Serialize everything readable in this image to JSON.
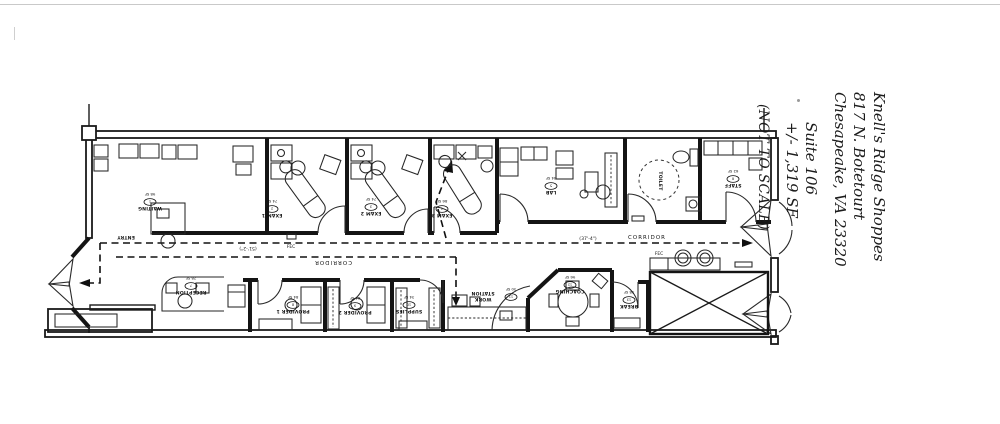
{
  "title_block": {
    "line1": "Knell's Ridge Shoppes",
    "line2": "817 N. Botetourt",
    "line3": "Chesapeake, VA 23320",
    "line4": "Suite 106",
    "line5": "+/- 1,319 SF",
    "line6": "(NOT TO SCALE)"
  },
  "labels": {
    "waiting": {
      "name": "WAITING",
      "tag": "1",
      "area": "98 SF"
    },
    "exam1": {
      "name": "EXAM 1",
      "tag": "2",
      "area": "74 SF"
    },
    "exam2": {
      "name": "EXAM 2",
      "tag": "3",
      "area": "74 SF"
    },
    "exam3": {
      "name": "EXAM 3",
      "tag": "4",
      "area": "86 SF"
    },
    "lab": {
      "name": "LAB",
      "tag": "5",
      "area": "84 SF"
    },
    "toilet": {
      "name": "TOILET"
    },
    "staff": {
      "name": "STAFF",
      "tag": "6",
      "area": "62 SF"
    },
    "entry": {
      "name": "ENTRY"
    },
    "reception": {
      "name": "RECEPTION",
      "tag": "7",
      "area": "78 SF"
    },
    "provider1": {
      "name": "PROVIDER 1",
      "tag": "8",
      "area": "84 SF"
    },
    "provider2": {
      "name": "PROVIDER 2",
      "tag": "9",
      "area": "84 SF"
    },
    "supplies": {
      "name": "SUPPLIES",
      "tag": "10",
      "area": "34 SF"
    },
    "workstation": {
      "name_line1": "WORK",
      "name_line2": "STATION",
      "tag": "11",
      "area": "30 SF"
    },
    "coaching": {
      "name": "COACHING",
      "tag": "12",
      "area": "96 SF"
    },
    "breakroom": {
      "name": "BREAK",
      "tag": "13",
      "area": "38 SF"
    },
    "corridor_top": "CORRIDOR",
    "corridor_bottom": "CORRIDOR",
    "dim_right": "(37'-4\")",
    "dim_left": "(51'-2\")",
    "fec1": "FEC",
    "fec2": "FEC"
  }
}
